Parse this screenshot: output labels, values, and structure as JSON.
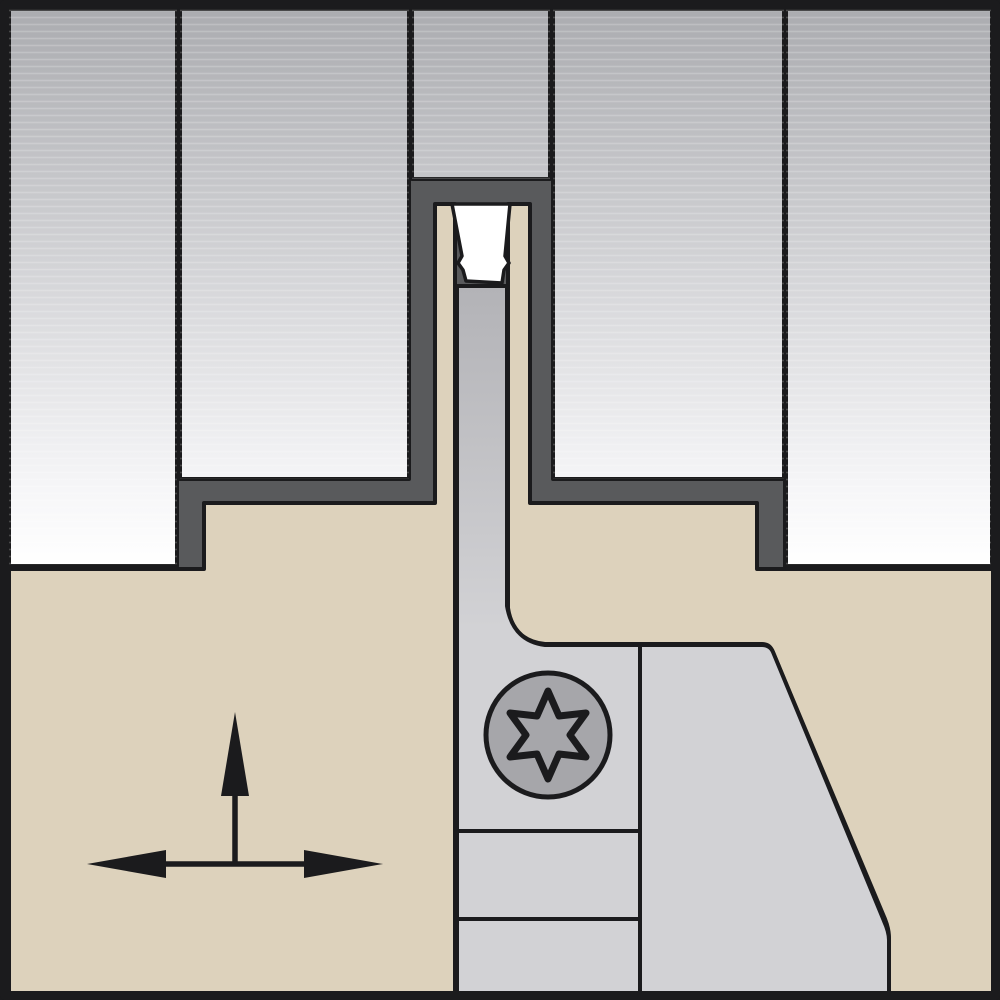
{
  "meta": {
    "description": "Technical line-art diagram: cross-section of a grooving / cut-off tool holder engaged in a machined groove of a workpiece, showing cutting insert, support blade, Torx clamp screw and feed-direction arrows",
    "diagram_type": "tooling-cross-section"
  },
  "colors": {
    "outline": "#1b1b1d",
    "workpiece_top": "#abacb0",
    "workpiece_bottom": "#f5f5f7",
    "white": "#ffffff",
    "cut_cavity": "#595a5c",
    "holder_tan": "#ddd2bc",
    "blade_gray": "#d2d2d5",
    "blade_top": "#b3b3b7",
    "screw_gray": "#a6a6aa",
    "insert_white": "#ffffff"
  },
  "parts": {
    "workpiece": "workpiece cross-section (five gradient wall segments around the groove)",
    "cavity": "machined groove / pocket cavity outline",
    "holder": "tool holder body with clamp arms",
    "insert": "grooving cutting insert",
    "blade": "support blade / cartridge with clamp sections",
    "screw": "Torx clamp screw head",
    "arrows": "feed direction indicator (axial and radial)"
  },
  "icons": {
    "torx_screw": "torx-screw-icon",
    "feed_arrows": "feed-direction-arrows-icon"
  }
}
